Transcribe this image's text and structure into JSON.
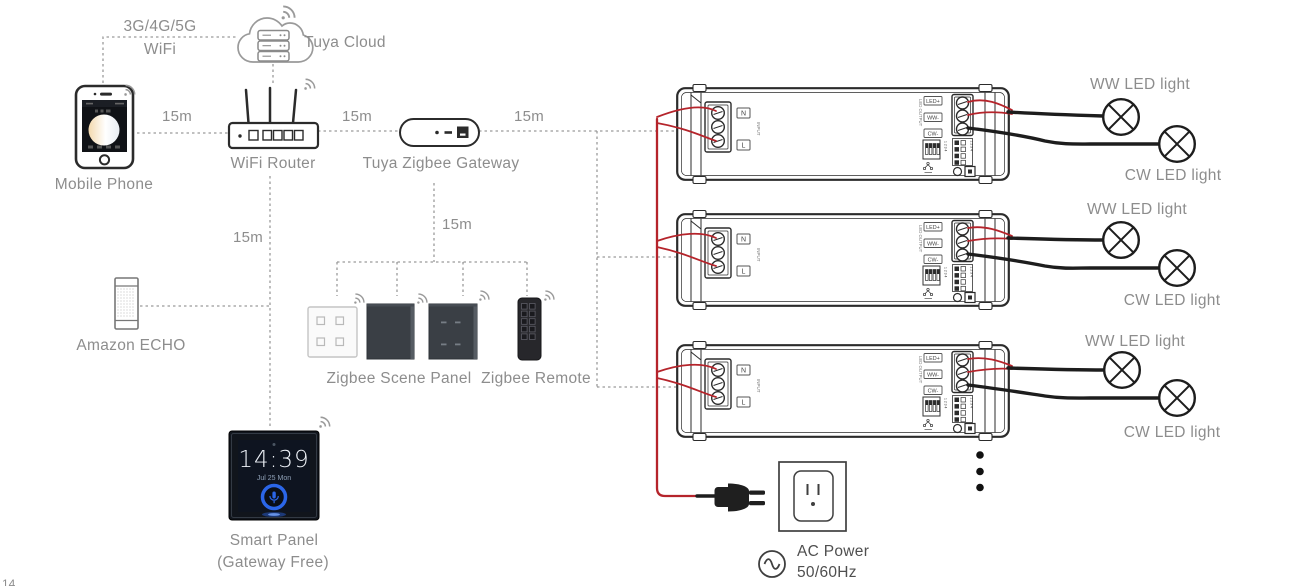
{
  "labels": {
    "network_line1": "3G/4G/5G",
    "network_line2": "WiFi",
    "tuya_cloud": "Tuya Cloud",
    "mobile_phone": "Mobile Phone",
    "wifi_router": "WiFi Router",
    "zigbee_gateway": "Tuya Zigbee Gateway",
    "amazon_echo": "Amazon ECHO",
    "scene_panel": "Zigbee Scene Panel",
    "zigbee_remote": "Zigbee Remote",
    "smart_panel_name": "Smart Panel",
    "smart_panel_sub": "(Gateway Free)",
    "ww_led": "WW LED light",
    "cw_led": "CW LED light",
    "ac_power_line1": "AC Power",
    "ac_power_line2": "50/60Hz",
    "distance": "15m",
    "corner_mark": "14"
  },
  "smart_panel_screen": {
    "time": "14:39",
    "date": "Jul 25 Mon"
  },
  "controller_silkscreen": {
    "n": "N",
    "l": "L",
    "input": "INPUT",
    "output": "LED OUTPUT",
    "out_led": "LED+",
    "out_ww": "WW-",
    "out_cw": "CW-",
    "dip": "1 2 3 4"
  },
  "colors": {
    "wire_red": "#b5242b",
    "wire_black": "#1d1d1d",
    "dashed_line": "#9a9a9a",
    "label_text": "#8d8d8d",
    "accent_blue": "#2b66e8"
  }
}
